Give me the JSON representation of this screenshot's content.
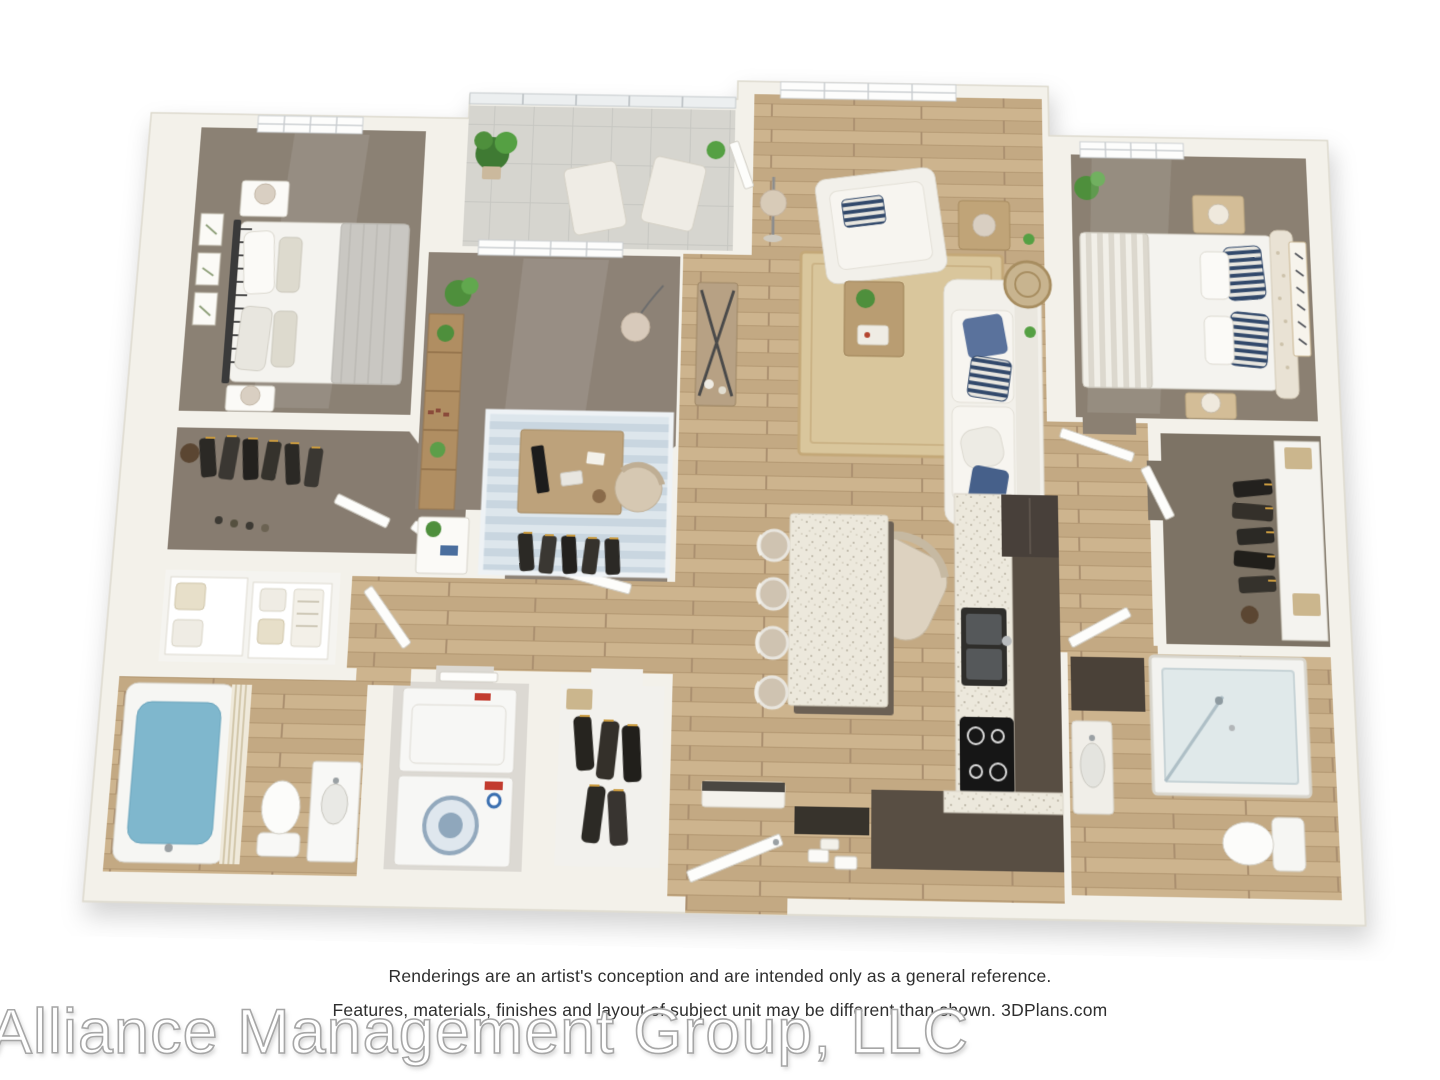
{
  "image": {
    "type": "3d-floor-plan-rendering",
    "width": 1440,
    "height": 1080
  },
  "disclaimer": {
    "line1": "Renderings are an artist's conception and are intended only as a general reference.",
    "line2": "Features, materials, finishes and layout of subject unit may be different than shown. 3DPlans.com"
  },
  "watermark": {
    "text": "Alliance Management Group, LLC"
  },
  "rooms": [
    "bedroom-1",
    "walk-in-closet-1",
    "linen-closet",
    "hallway",
    "bathroom-1",
    "laundry-closet",
    "coat-closet",
    "entry",
    "pantry",
    "office-den",
    "bedroom-closet",
    "balcony",
    "living-room",
    "dining-area",
    "kitchen",
    "hall-right",
    "bedroom-2",
    "walk-in-closet-2",
    "bathroom-2"
  ],
  "palette": {
    "background": "#ffffff",
    "walls": "#f3f1ea",
    "wall_edge": "#dbd7cb",
    "wood_floor": "#c8af8a",
    "carpet": "#8b8174",
    "balcony_concrete": "#d6d5cf",
    "kitchen_cabinets": "#584e43",
    "counter_top": "#ebe7db",
    "jute_rug": "#d9c69c",
    "office_rug": "#cfdae4",
    "pillow_blue": "#5a729c",
    "pillow_navy": "#32496b",
    "tub_water": "#7fb7cd",
    "plant_green": "#4e8f3c",
    "furniture_white": "#f3f1ec",
    "furniture_wood": "#b99d72",
    "text": "#2e2e2e",
    "watermark_stroke": "#a6a6a6"
  }
}
